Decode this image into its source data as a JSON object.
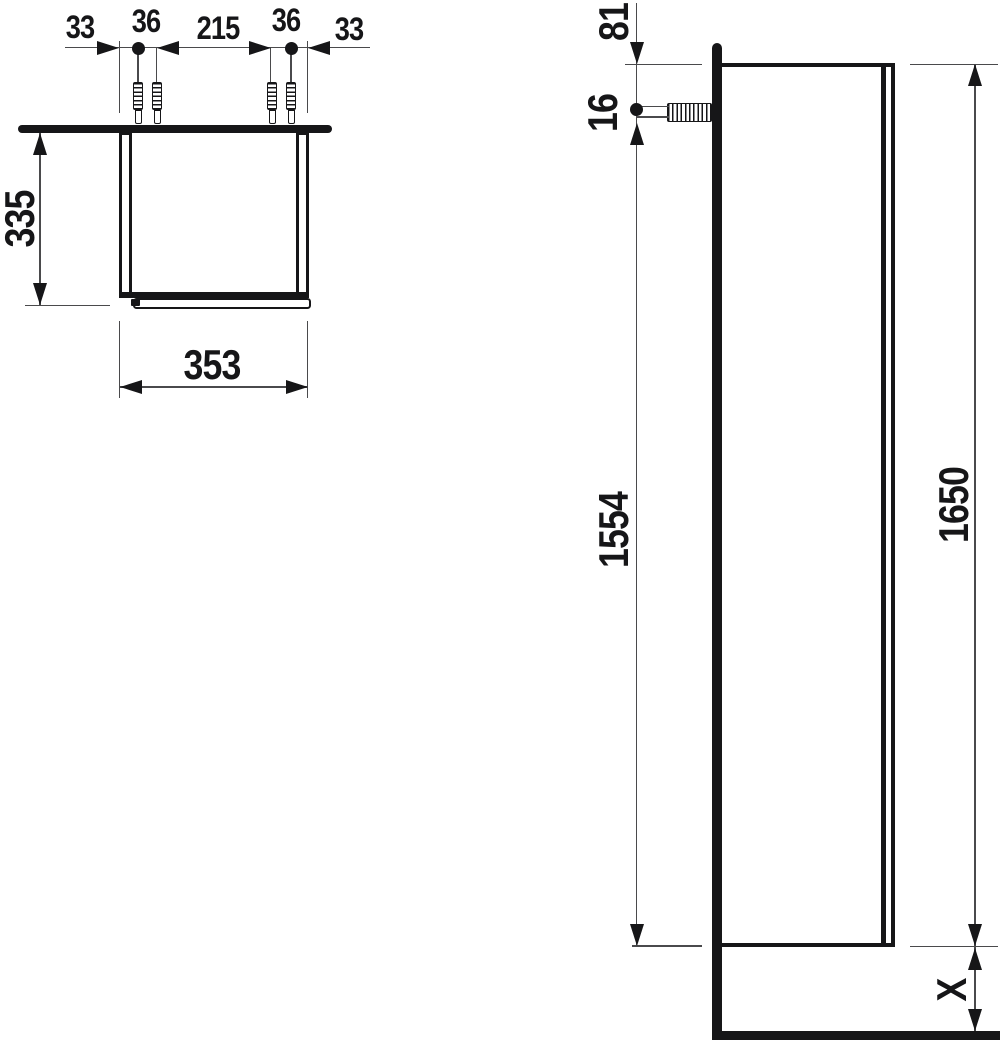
{
  "top_view": {
    "chain": [
      "33",
      "36",
      "215",
      "36",
      "33"
    ],
    "depth": "335",
    "width": "353"
  },
  "side_view": {
    "top_offset": "81",
    "hole": "16",
    "hole_to_bottom": "1554",
    "total_height": "1650",
    "clearance": "X"
  },
  "colors": {
    "object_line": "#161618",
    "dimension_line": "#4a4a4c",
    "background": "#ffffff"
  }
}
